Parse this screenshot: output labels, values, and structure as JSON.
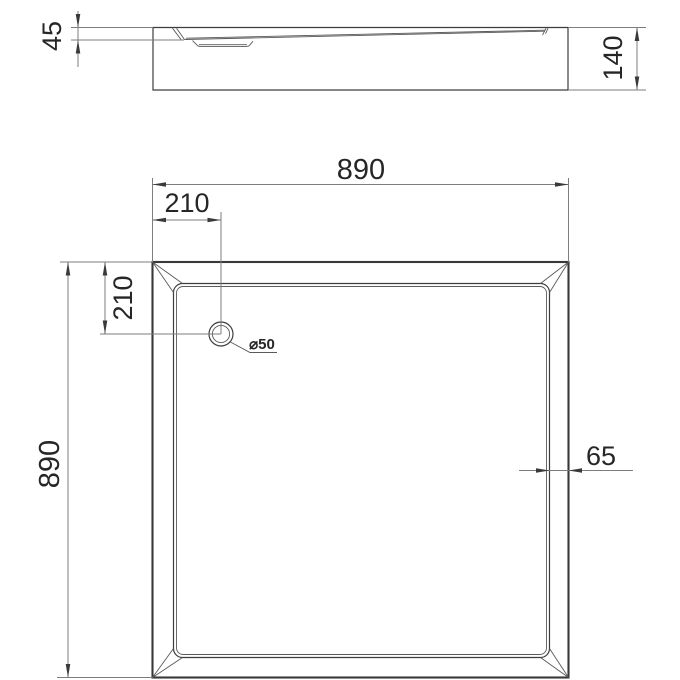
{
  "colors": {
    "geometry": "#3d3d3d",
    "dimension": "#7d7d7d",
    "text": "#262626",
    "background": "#ffffff"
  },
  "labels": {
    "rim_height": "45",
    "total_height": "140",
    "overall_width": "890",
    "overall_length": "890",
    "drain_offset_x": "210",
    "drain_offset_y": "210",
    "drain_diameter": "⌀50",
    "border_width": "65"
  }
}
